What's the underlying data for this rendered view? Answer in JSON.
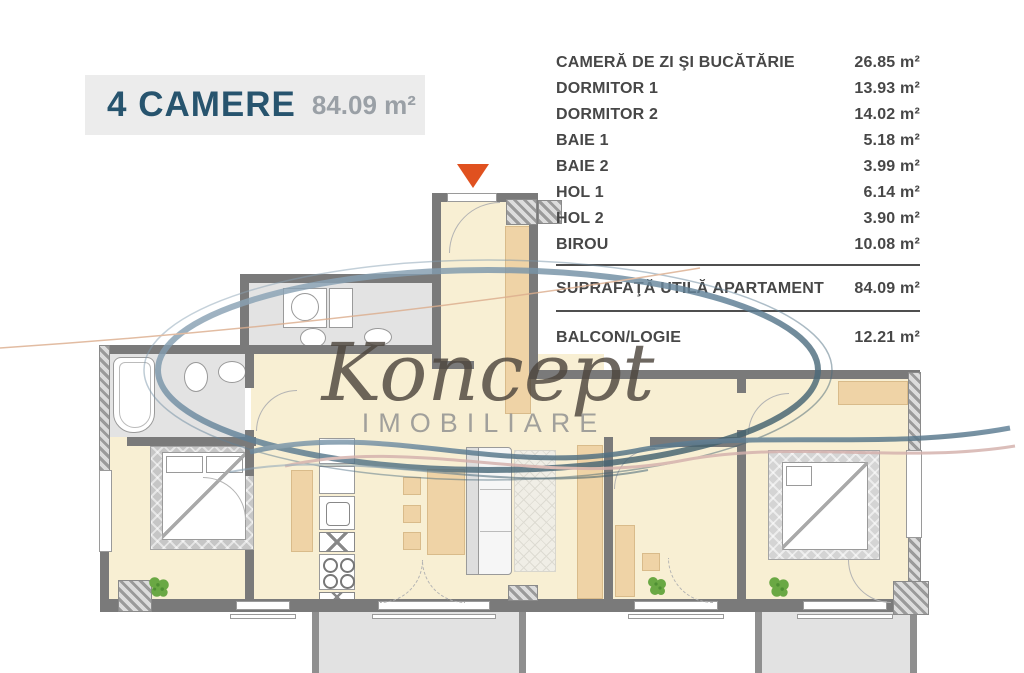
{
  "title": {
    "name": "4 CAMERE",
    "area": "84.09 m²"
  },
  "legend": {
    "rows": [
      {
        "label": "CAMERĂ DE ZI ŞI BUCĂTĂRIE",
        "value": "26.85 m²"
      },
      {
        "label": "DORMITOR 1",
        "value": "13.93 m²"
      },
      {
        "label": "DORMITOR 2",
        "value": "14.02 m²"
      },
      {
        "label": "BAIE 1",
        "value": "5.18 m²"
      },
      {
        "label": "BAIE 2",
        "value": "3.99 m²"
      },
      {
        "label": "HOL 1",
        "value": "6.14 m²"
      },
      {
        "label": "HOL 2",
        "value": "3.90 m²"
      },
      {
        "label": "BIROU",
        "value": "10.08 m²"
      }
    ],
    "total": {
      "label": "SUPRAFAŢĂ UTILĂ APARTAMENT",
      "value": "84.09 m²"
    },
    "balcony": {
      "label": "BALCON/LOGIE",
      "value": "12.21 m²"
    }
  },
  "watermark": {
    "brand": "Koncept",
    "subtitle": "IMOBILIARE"
  },
  "icons": {
    "entrance_marker": "orange-down-triangle",
    "plant": "green-plant"
  },
  "colors": {
    "accent_arrow": "#e0511f",
    "title_text": "#27546e",
    "title_bg": "#ececec",
    "wall": "#7a7a7a",
    "floor_cream": "#f8efd3",
    "floor_gray": "#e3e3e3",
    "furniture_tan": "#efd3a6",
    "balcony": "#e2e2e2",
    "legend_text": "#474747",
    "watermark_blue": "#5e7f96",
    "watermark_pink": "#d4b0ac"
  }
}
